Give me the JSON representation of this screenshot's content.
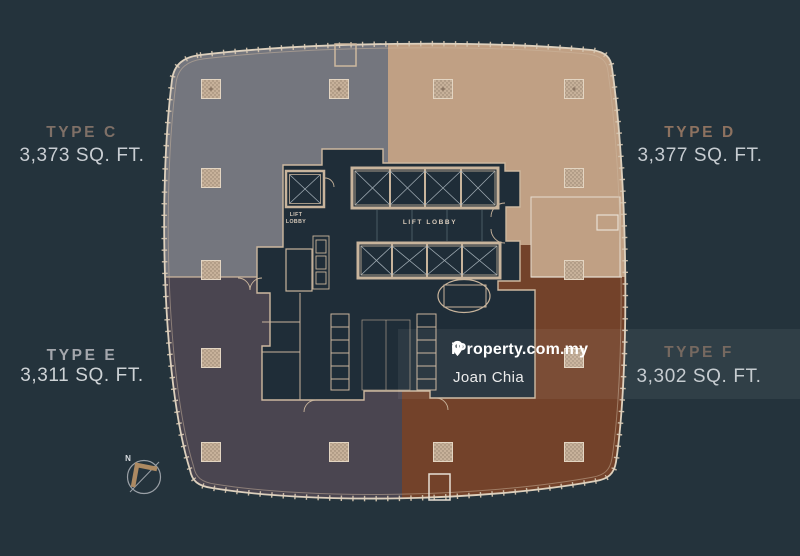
{
  "page": {
    "background_color": "#24333c",
    "description": "Tower floor plate plan with four unit types"
  },
  "units": [
    {
      "id": "type-c",
      "label": "TYPE C",
      "area": "3,373 SQ. FT.",
      "color": "#74767e",
      "label_color": "#7f7067",
      "area_color": "#c9ced3"
    },
    {
      "id": "type-d",
      "label": "TYPE D",
      "area": "3,377 SQ. FT.",
      "color": "#c0a084",
      "label_color": "#8d7260",
      "area_color": "#c6ccd1"
    },
    {
      "id": "type-e",
      "label": "TYPE E",
      "area": "3,311 SQ. FT.",
      "color": "#4a4550",
      "label_color": "#a4a7ad",
      "area_color": "#ced3d6"
    },
    {
      "id": "type-f",
      "label": "TYPE F",
      "area": "3,302 SQ. FT.",
      "color": "#73422a",
      "label_color": "#6e6057",
      "area_color": "#c3c9ce"
    }
  ],
  "floorplan": {
    "lift_lobby_main": "LIFT LOBBY",
    "lift_lobby_small_line1": "LIFT",
    "lift_lobby_small_line2": "LOBBY",
    "wall_color": "#d6c6b1",
    "core_color": "#1f2d38"
  },
  "compass": {
    "north_label": "N"
  },
  "watermark": {
    "brand": "iProperty.com.my",
    "agent": "Joan Chia",
    "text_color": "#ffffff",
    "band_color": "rgba(255,255,255,0.06)"
  }
}
